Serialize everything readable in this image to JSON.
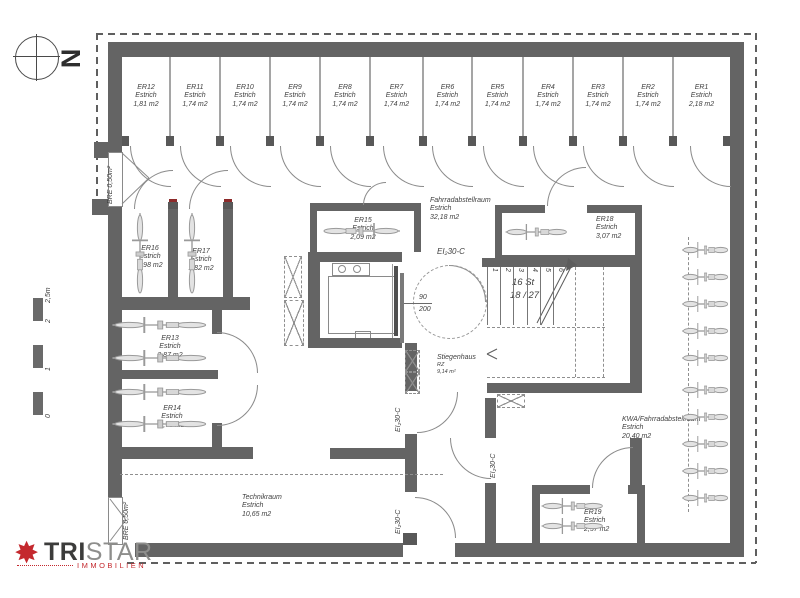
{
  "plan": {
    "compass_label": "N",
    "scale_labels": [
      "0",
      "1",
      "2",
      "2,5m"
    ],
    "fire_rating_label": "EI₂30-C",
    "opening_label": "BRE 0,50m²",
    "door_width": "90",
    "door_height": "200",
    "stairs": {
      "steps": "16 St",
      "ratio": "18 / 27",
      "numbers": [
        "1",
        "2",
        "3",
        "4",
        "5",
        "6"
      ]
    },
    "stiegenhaus": {
      "name": "Stiegenhaus",
      "code": "RZ",
      "area": "9,14 m²"
    },
    "top_rooms": [
      {
        "id": "ER12",
        "type": "Estrich",
        "area": "1,81 m2"
      },
      {
        "id": "ER11",
        "type": "Estrich",
        "area": "1,74 m2"
      },
      {
        "id": "ER10",
        "type": "Estrich",
        "area": "1,74 m2"
      },
      {
        "id": "ER9",
        "type": "Estrich",
        "area": "1,74 m2"
      },
      {
        "id": "ER8",
        "type": "Estrich",
        "area": "1,74 m2"
      },
      {
        "id": "ER7",
        "type": "Estrich",
        "area": "1,74 m2"
      },
      {
        "id": "ER6",
        "type": "Estrich",
        "area": "1,74 m2"
      },
      {
        "id": "ER5",
        "type": "Estrich",
        "area": "1,74 m2"
      },
      {
        "id": "ER4",
        "type": "Estrich",
        "area": "1,74 m2"
      },
      {
        "id": "ER3",
        "type": "Estrich",
        "area": "1,74 m2"
      },
      {
        "id": "ER2",
        "type": "Estrich",
        "area": "1,74 m2"
      },
      {
        "id": "ER1",
        "type": "Estrich",
        "area": "2,18 m2"
      }
    ],
    "rooms": {
      "er16": {
        "id": "ER16",
        "type": "Estrich",
        "area": "1,98 m2"
      },
      "er17": {
        "id": "ER17",
        "type": "Estrich",
        "area": "1,82 m2"
      },
      "er13": {
        "id": "ER13",
        "type": "Estrich",
        "area": "2,87 m2"
      },
      "er14": {
        "id": "ER14",
        "type": "Estrich",
        "area": "2,75 m2"
      },
      "er15": {
        "id": "ER15",
        "type": "Estrich",
        "area": "2,09 m2"
      },
      "er18": {
        "id": "ER18",
        "type": "Estrich",
        "area": "3,07 m2"
      },
      "er19": {
        "id": "ER19",
        "type": "Estrich",
        "area": "2,57 m2"
      },
      "fahrradraum": {
        "id": "Fahrradabstellraum",
        "type": "Estrich",
        "area": "32,18 m2"
      },
      "kwa": {
        "id": "KWA/Fahrradabstellraum",
        "type": "Estrich",
        "area": "20,40 m2"
      },
      "technikraum": {
        "id": "Technikraum",
        "type": "Estrich",
        "area": "10,65 m2"
      }
    }
  },
  "logo": {
    "name_bold": "TRI",
    "name_light": "STAR",
    "subtitle": "IMMOBILIEN"
  },
  "colors": {
    "wall": "#646464",
    "line": "#9a9a9a",
    "text": "#3f3f3f",
    "logo_red": "#c4292e"
  }
}
